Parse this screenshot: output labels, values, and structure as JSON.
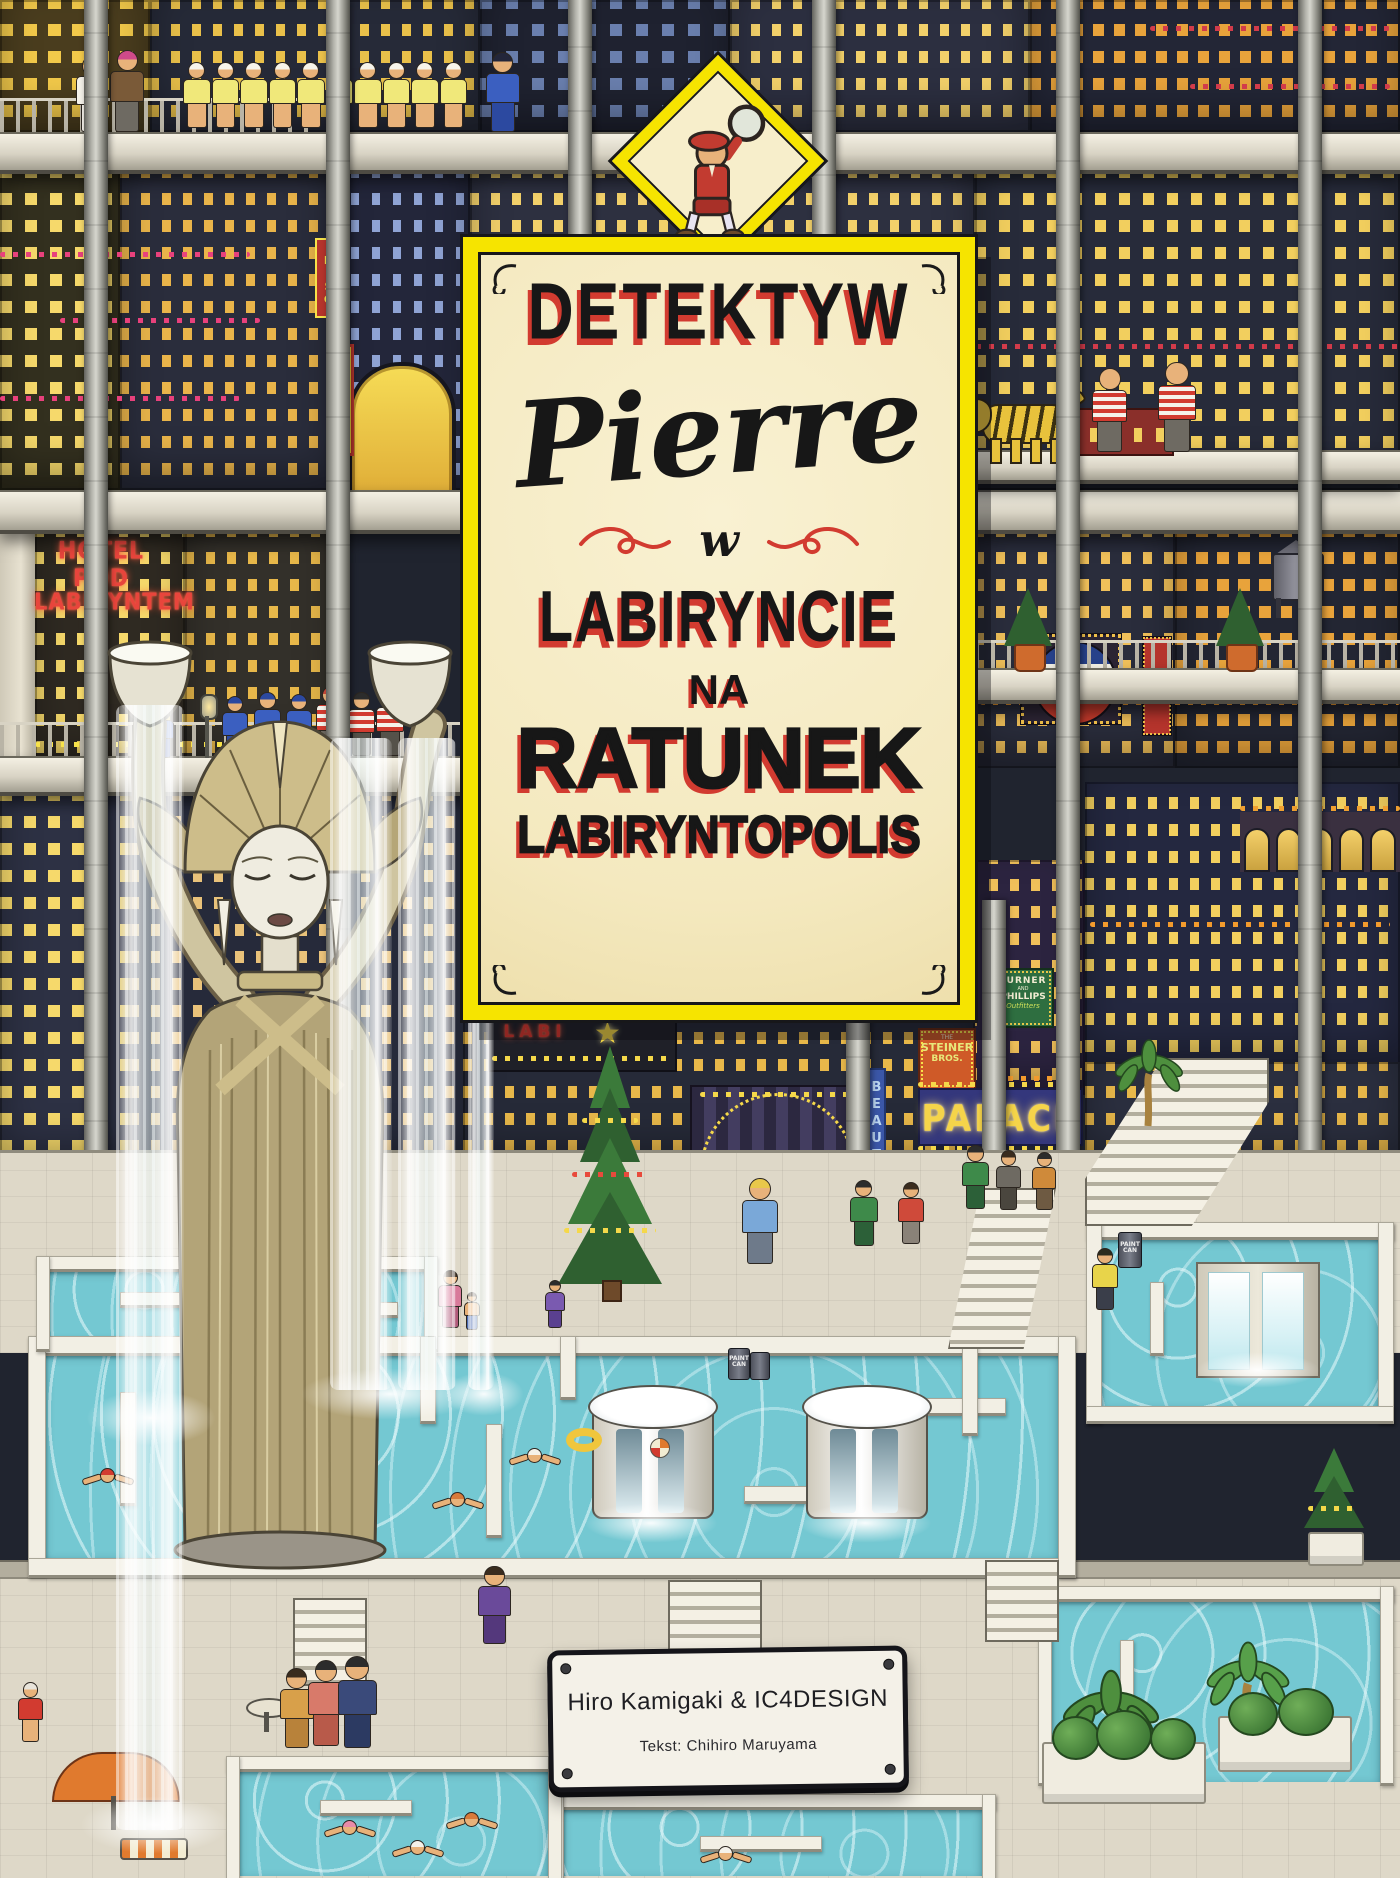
{
  "title": {
    "kicker": "DETEKTYW",
    "name": "Pierre",
    "connector": "w",
    "place": "LABIRYNCIE",
    "subtitle_1": "NA",
    "subtitle_2": "RATUNEK",
    "subtitle_3": "LABIRYNTOPOLIS"
  },
  "credits": {
    "authors": "Hiro Kamigaki & IC4DESIGN",
    "text_by": "Tekst: Chihiro Maruyama"
  },
  "signs": {
    "hotel_line1": "HOTEL POD",
    "hotel_line2": "LABIRYNTEM",
    "tagos": "TAGOS",
    "paradiso": "DISO",
    "cola": "CalCola",
    "turner_line1": "TURNER",
    "turner_line2": "AND",
    "turner_line3": "PHILLIPS",
    "turner_line4": "Outfitters",
    "steiner_line1": "THE",
    "steiner_line2": "STEINER",
    "steiner_line3": "BROS.",
    "palace": "PALACE",
    "beauty": "BEAUTY PA",
    "grand": "GRAND",
    "labi": "LABI",
    "paint_can_line1": "PAINT",
    "paint_can_line2": "CAN",
    "tree_star": "★"
  },
  "colors": {
    "plaque_yellow": "#f6e400",
    "plaque_cream": "#f7eecb",
    "accent_red": "#d23b30",
    "ink_black": "#171717",
    "neon_pink": "#e8417c",
    "neon_orange": "#f39b2d",
    "window_yellow": "#f6d96b",
    "pool_turquoise": "#74c8d2",
    "night_blue": "#262a36"
  }
}
